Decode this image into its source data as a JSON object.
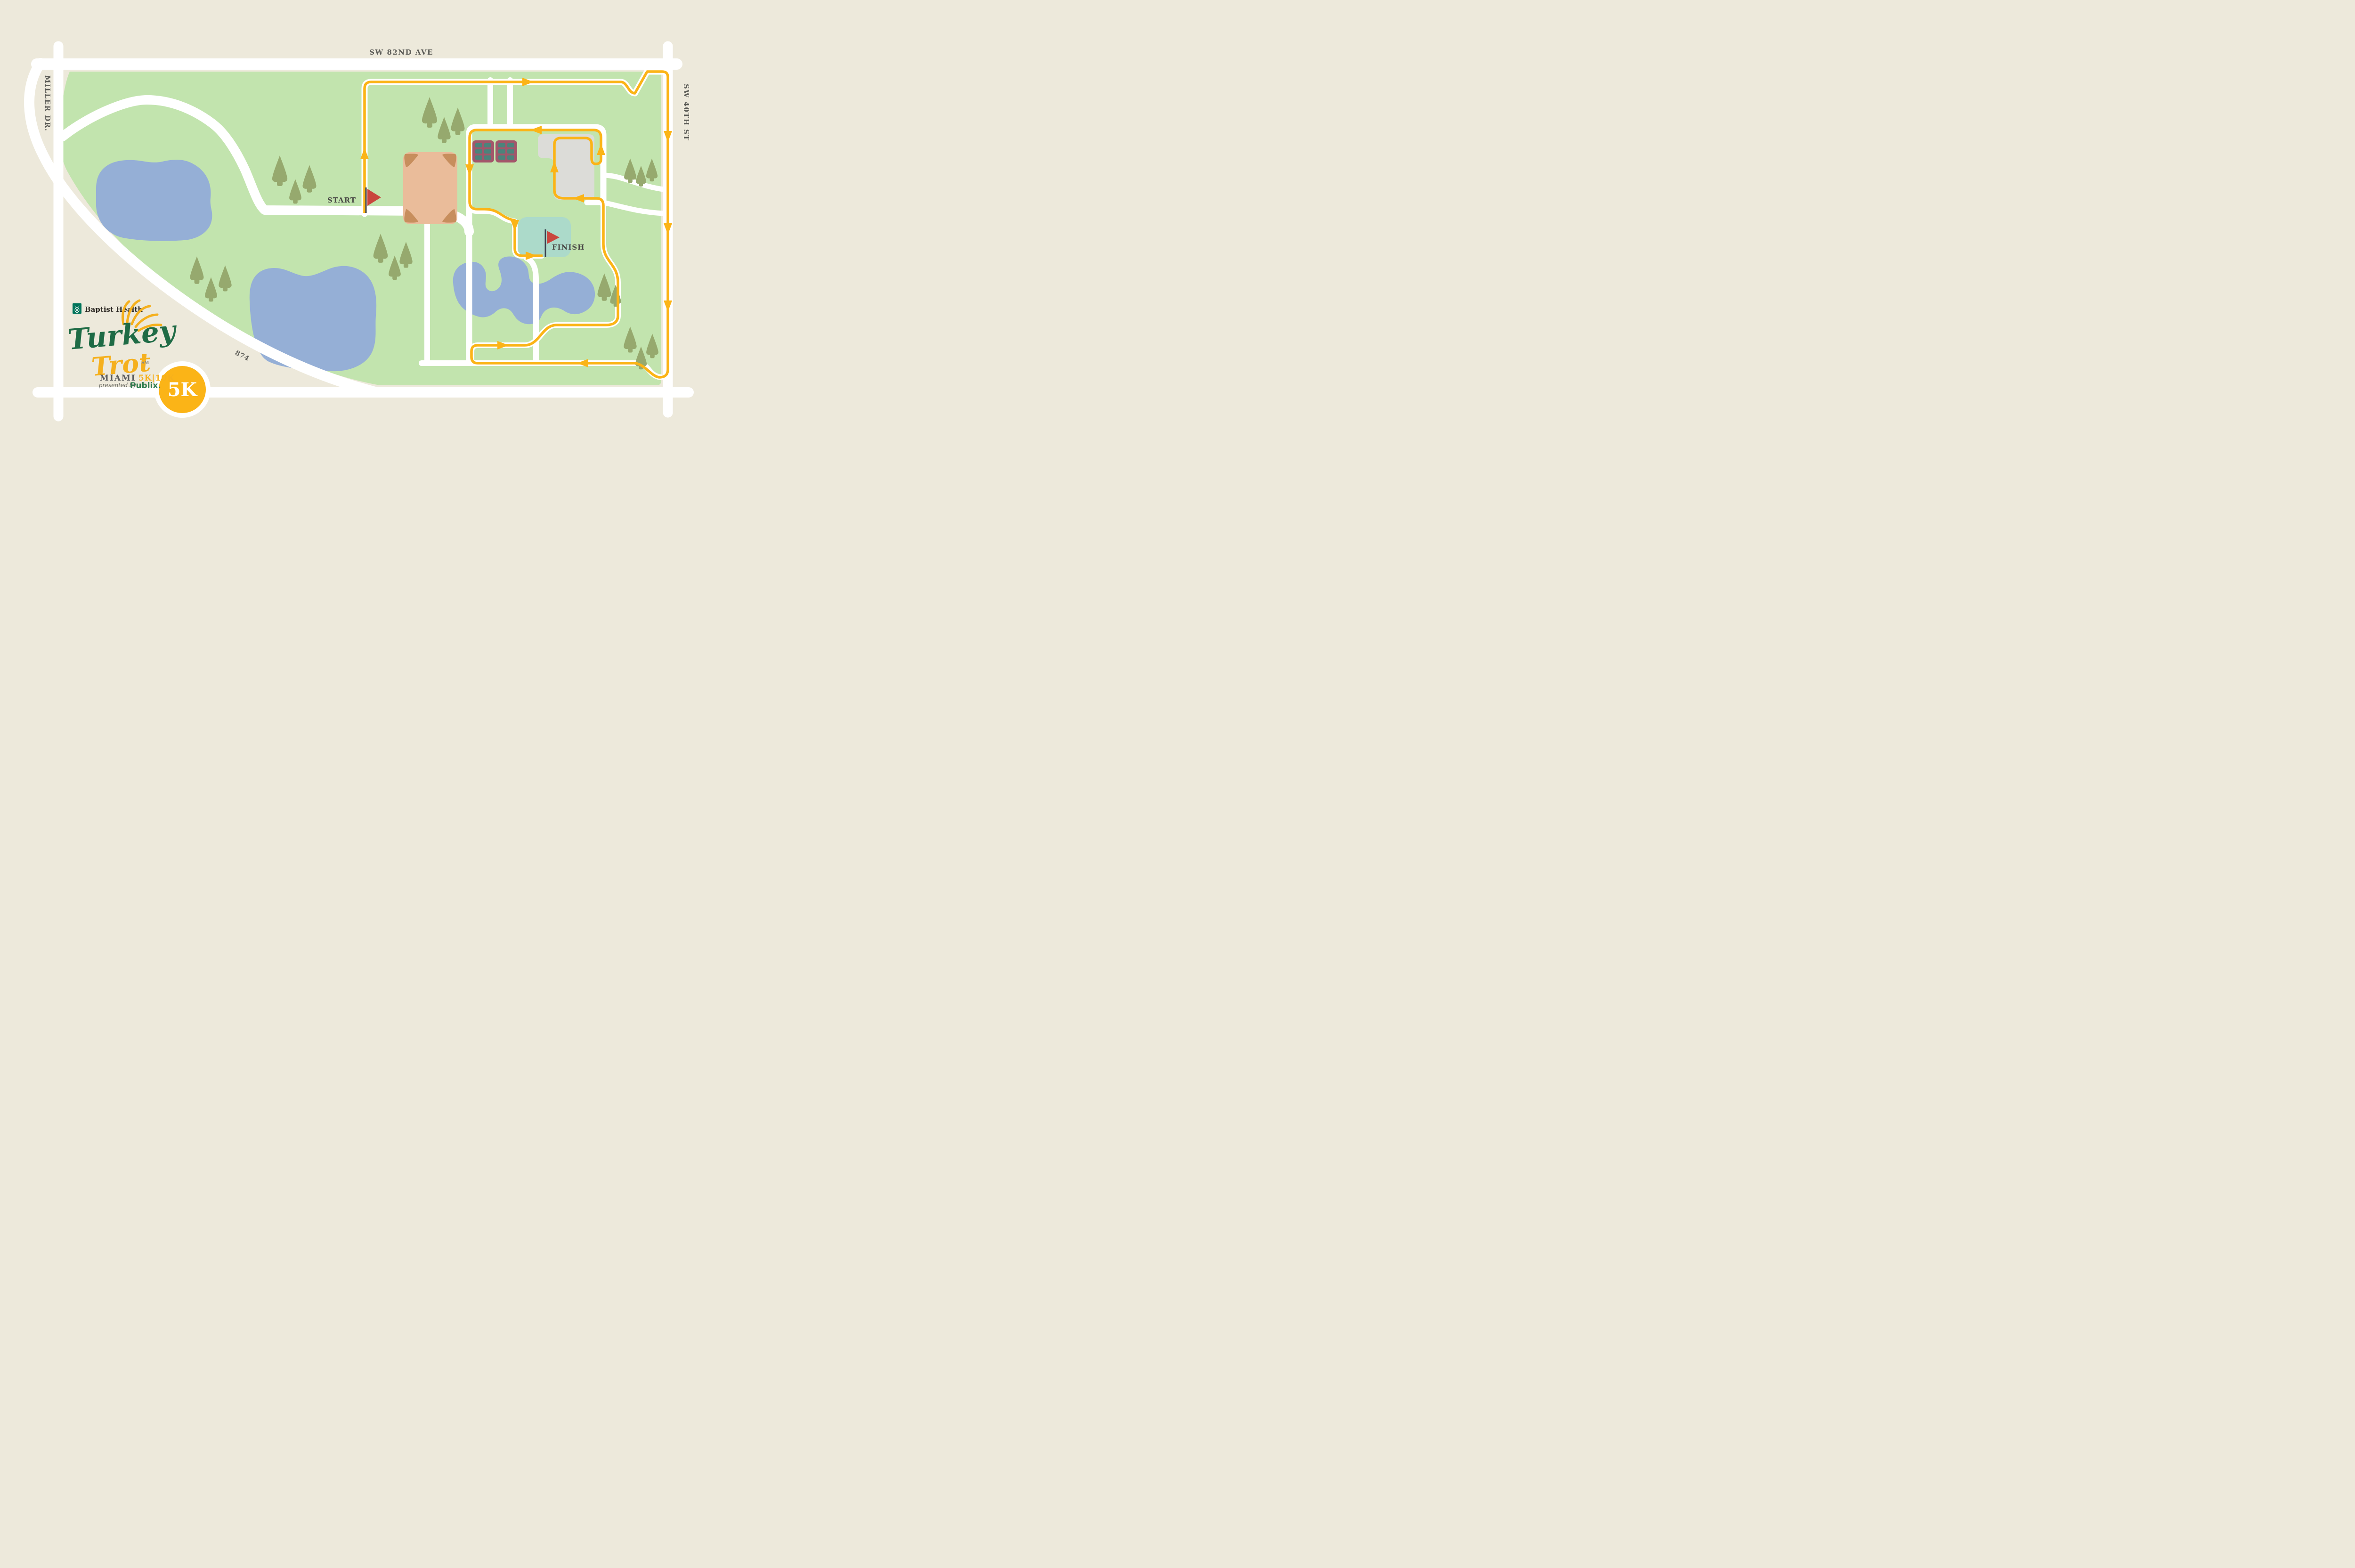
{
  "map": {
    "title_hint": "Turkey Trot Miami 5K course map",
    "roads": {
      "top": "SW 82ND AVE",
      "left": "MILLER DR.",
      "right": "SW 40TH ST",
      "diagonal": "874"
    },
    "markers": {
      "start": "START",
      "finish": "FINISH",
      "badge": "5K"
    },
    "logo": {
      "sponsor": "Baptist Health",
      "title_line1": "Turkey",
      "title_line2": "Trot",
      "trademark": "SM",
      "city": "MIAMI",
      "distances": "5K|10K",
      "presented_by": "presented by",
      "presenter": "Publix."
    },
    "colors": {
      "bg": "#EDE9DB",
      "green": "#C2E4AE",
      "road": "#FFFFFF",
      "lake": "#95AFD6",
      "route": "#FBB417",
      "tree": "#96A96E",
      "maroon": "#A3566A",
      "inset": "#4C837B",
      "building": "#DCDCD8",
      "pool": "#ACDACA",
      "field": "#EABC9A",
      "fieldcorner": "#C78E5D",
      "label": "#5C5C57",
      "flag": "#C9463E",
      "logogreen": "#1E6B45",
      "logoyellow": "#F5B01D",
      "publix": "#2E7D4F",
      "baptist": "#00745A"
    }
  }
}
